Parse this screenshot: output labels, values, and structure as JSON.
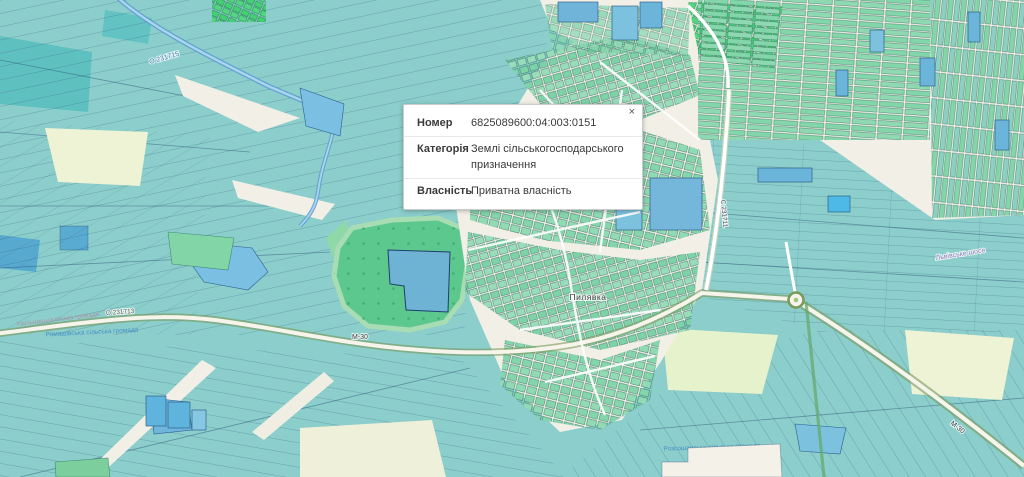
{
  "popup": {
    "close_icon": "×",
    "rows": [
      {
        "label": "Номер",
        "value": "6825089600:04:003:0151"
      },
      {
        "label": "Категорія",
        "value": "Землі сільськогосподарського призначення"
      },
      {
        "label": "Власність",
        "value": "Приватна власність"
      }
    ]
  },
  "map": {
    "labels": {
      "stream_code": "О 231715",
      "road_code_west": "О 231713",
      "highway_code_center": "М-30",
      "highway_code_southeast": "М-30",
      "road_code_vertical": "С 231711",
      "street_northeast": "Львівське шосе",
      "village": "Пилявка",
      "hromada_pink_west": "Хмільницька міська громада",
      "hromada_blue_west": "Ромашівська сільська громада",
      "hromada_blue_south": "Розсошанська сільська громада"
    },
    "colors": {
      "background": "#f2efe6",
      "parcel_teal": "#8bcecb",
      "parcel_teal_dark": "#5fc0c0",
      "parcel_mint": "#84d5ac",
      "parcel_green_bright": "#44cf74",
      "parcel_blue": "#70b5d9",
      "forest_green": "#5cc88e",
      "water_blue": "#7bbfe2",
      "road_casing_green": "#7a9a5c",
      "pale_field": "#edf3d4"
    }
  }
}
